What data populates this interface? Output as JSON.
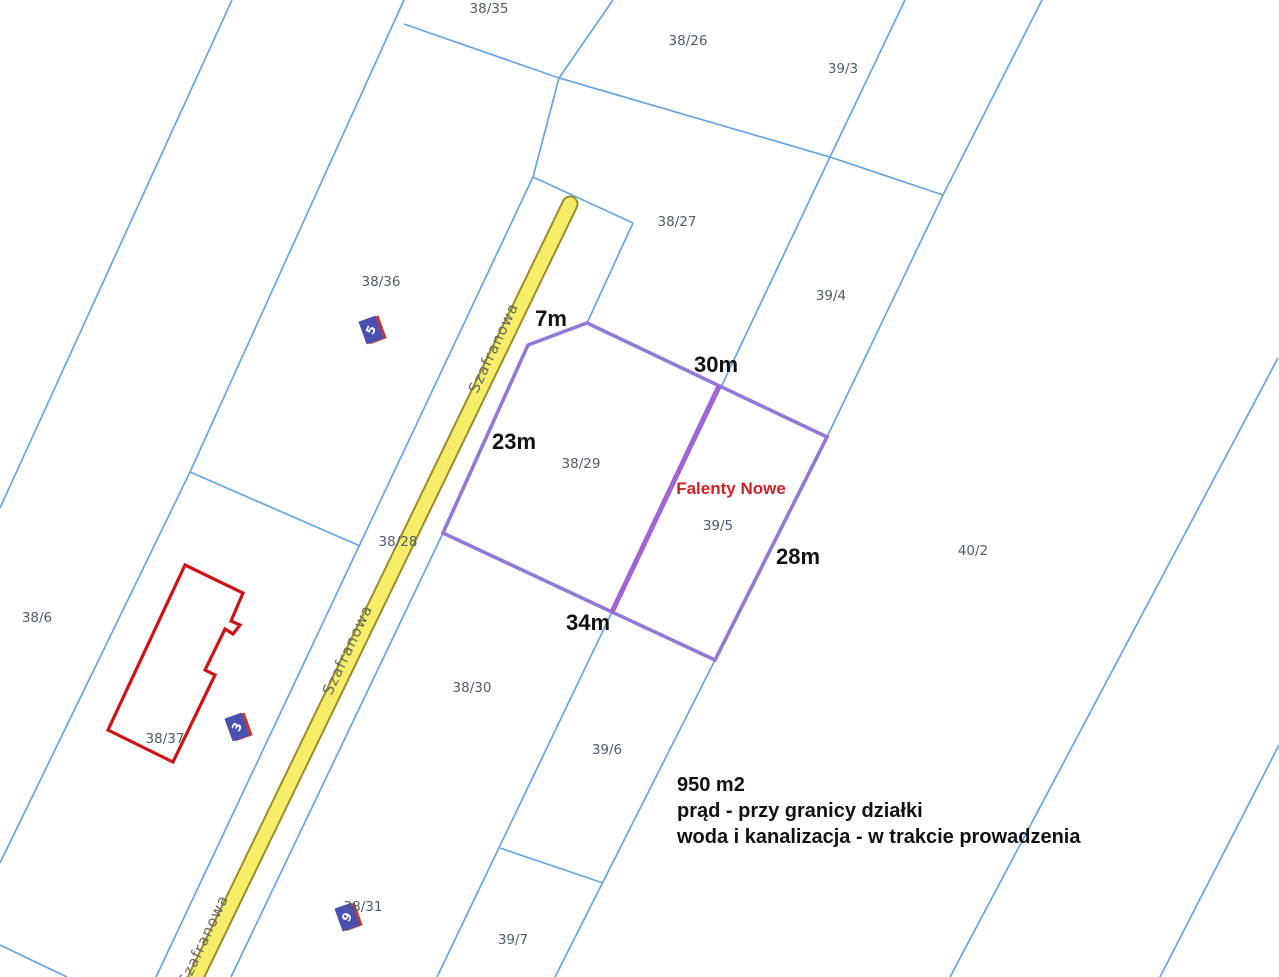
{
  "map": {
    "title": "Cadastral parcel map",
    "colors": {
      "background": "#FFFFFF",
      "boundary": "#64A6E3",
      "road_fill": "#F6EE68",
      "road_border": "#9C8C2A",
      "plot": "#9478D8",
      "plot_divider": "#A263D6",
      "building": "#D01216",
      "marker_fill": "#4A50B2",
      "marker_shadow": "#C23A32",
      "marker_text": "#FFFFFF",
      "parcel_label": "#4D5D6D",
      "street_label": "#666A5E",
      "dimension_label": "#111111",
      "place_label": "#D22027",
      "info_text": "#111111"
    },
    "boundary_lines": [
      {
        "name": "west-1",
        "points": [
          [
            232,
            0
          ],
          [
            0,
            508
          ]
        ]
      },
      {
        "name": "west-2",
        "points": [
          [
            404,
            0
          ],
          [
            190,
            472
          ],
          [
            0,
            863
          ]
        ]
      },
      {
        "name": "cross-north",
        "points": [
          [
            404,
            24
          ],
          [
            559,
            78
          ],
          [
            830,
            157
          ],
          [
            943,
            195
          ]
        ]
      },
      {
        "name": "north-spur",
        "points": [
          [
            613,
            0
          ],
          [
            559,
            78
          ],
          [
            533,
            177
          ]
        ]
      },
      {
        "name": "road-head-cross",
        "points": [
          [
            533,
            177
          ],
          [
            633,
            223
          ]
        ]
      },
      {
        "name": "parcel-3827-west",
        "points": [
          [
            633,
            223
          ],
          [
            587,
            323
          ]
        ]
      },
      {
        "name": "road-west",
        "points": [
          [
            533,
            177
          ],
          [
            156,
            977
          ]
        ]
      },
      {
        "name": "road-east",
        "points": [
          [
            587,
            323
          ],
          [
            528,
            345
          ],
          [
            443,
            533
          ],
          [
            231,
            977
          ]
        ]
      },
      {
        "name": "mid-east",
        "points": [
          [
            905,
            0
          ],
          [
            830,
            157
          ],
          [
            721,
            387
          ],
          [
            612,
            612
          ],
          [
            437,
            977
          ]
        ]
      },
      {
        "name": "east-1",
        "points": [
          [
            1042,
            0
          ],
          [
            943,
            195
          ],
          [
            827,
            437
          ],
          [
            715,
            660
          ],
          [
            555,
            977
          ]
        ]
      },
      {
        "name": "cross-west",
        "points": [
          [
            190,
            472
          ],
          [
            360,
            546
          ]
        ]
      },
      {
        "name": "cross-south",
        "points": [
          [
            500,
            848
          ],
          [
            603,
            883
          ]
        ]
      },
      {
        "name": "east-2",
        "points": [
          [
            1278,
            358
          ],
          [
            950,
            977
          ]
        ]
      },
      {
        "name": "east-3",
        "points": [
          [
            1279,
            745
          ],
          [
            1160,
            977
          ]
        ]
      },
      {
        "name": "corner-southwest",
        "points": [
          [
            0,
            945
          ],
          [
            67,
            977
          ]
        ]
      }
    ],
    "road": {
      "name": "Szafranowa",
      "points": [
        [
          570,
          204
        ],
        [
          196,
          977
        ]
      ],
      "fill_width": 13,
      "border_width": 17
    },
    "street_labels": [
      {
        "text": "Szafranowa",
        "x": 498,
        "y": 350,
        "angle": -65
      },
      {
        "text": "Szafranowa",
        "x": 352,
        "y": 652,
        "angle": -65
      },
      {
        "text": "Szafranowa",
        "x": 208,
        "y": 942,
        "angle": -65
      }
    ],
    "plot_outline": {
      "points": [
        [
          528,
          345
        ],
        [
          587,
          323
        ],
        [
          827,
          437
        ],
        [
          715,
          660
        ],
        [
          612,
          612
        ],
        [
          443,
          533
        ]
      ]
    },
    "plot_divider": {
      "points": [
        [
          719,
          386
        ],
        [
          612,
          612
        ]
      ]
    },
    "building": {
      "points": [
        [
          185,
          565
        ],
        [
          243,
          593
        ],
        [
          231,
          621
        ],
        [
          240,
          625
        ],
        [
          233,
          634
        ],
        [
          225,
          629
        ],
        [
          205,
          670
        ],
        [
          215,
          675
        ],
        [
          173,
          762
        ],
        [
          108,
          730
        ]
      ]
    },
    "house_markers": [
      {
        "number": "5",
        "x": 371,
        "y": 330,
        "angle": -20
      },
      {
        "number": "3",
        "x": 237,
        "y": 727,
        "angle": -20
      },
      {
        "number": "9",
        "x": 347,
        "y": 917,
        "angle": -20
      }
    ],
    "parcel_labels": [
      {
        "text": "38/35",
        "x": 489,
        "y": 13
      },
      {
        "text": "38/26",
        "x": 688,
        "y": 45
      },
      {
        "text": "39/3",
        "x": 843,
        "y": 73
      },
      {
        "text": "38/27",
        "x": 677,
        "y": 226
      },
      {
        "text": "39/4",
        "x": 831,
        "y": 300
      },
      {
        "text": "38/36",
        "x": 381,
        "y": 286
      },
      {
        "text": "38/29",
        "x": 581,
        "y": 468
      },
      {
        "text": "39/5",
        "x": 718,
        "y": 530
      },
      {
        "text": "40/2",
        "x": 973,
        "y": 555
      },
      {
        "text": "38/28",
        "x": 398,
        "y": 546
      },
      {
        "text": "38/6",
        "x": 37,
        "y": 622
      },
      {
        "text": "38/37",
        "x": 165,
        "y": 743
      },
      {
        "text": "38/30",
        "x": 472,
        "y": 692
      },
      {
        "text": "39/6",
        "x": 607,
        "y": 754
      },
      {
        "text": "38/31",
        "x": 363,
        "y": 911
      },
      {
        "text": "39/7",
        "x": 513,
        "y": 944
      }
    ],
    "dimension_labels": [
      {
        "text": "7m",
        "x": 551,
        "y": 326
      },
      {
        "text": "30m",
        "x": 716,
        "y": 372
      },
      {
        "text": "23m",
        "x": 514,
        "y": 449
      },
      {
        "text": "28m",
        "x": 798,
        "y": 564
      },
      {
        "text": "34m",
        "x": 588,
        "y": 630
      }
    ],
    "place_label": {
      "text": "Falenty Nowe",
      "x": 731,
      "y": 494
    },
    "info_text": {
      "lines": [
        "950 m2",
        "prąd - przy granicy działki",
        "woda i kanalizacja - w trakcie prowadzenia"
      ]
    }
  }
}
